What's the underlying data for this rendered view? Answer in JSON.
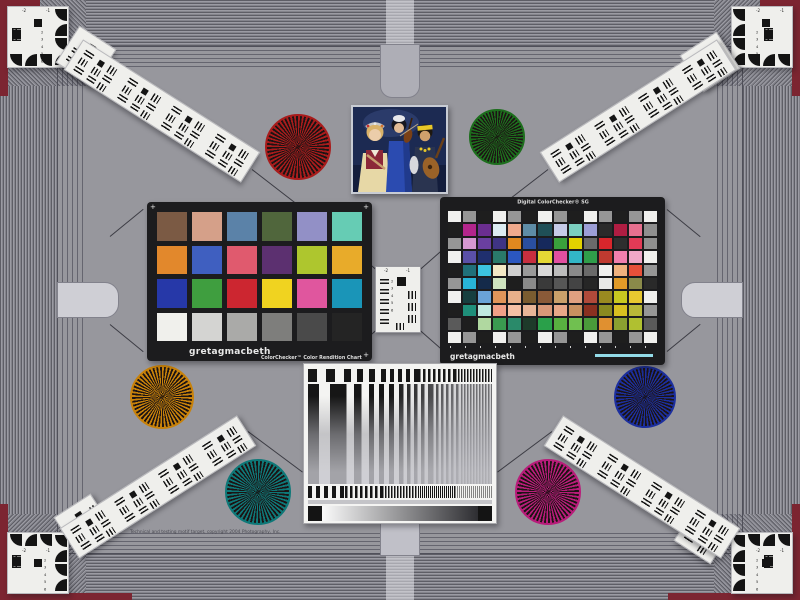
{
  "colors": {
    "background": "#97979d",
    "corner_red": "#7c2531",
    "card_black": "#1c1c1e",
    "card_white": "#efefec",
    "sg_ruler": "#93dbe8"
  },
  "colorchecker24": {
    "brand": "gretagmacbeth",
    "name": "ColorChecker™ Color Rendition Chart",
    "corner_mark": "+",
    "rows": [
      [
        "#7b5a44",
        "#d5a089",
        "#5b82a8",
        "#50663c",
        "#9290c6",
        "#66ccb4"
      ],
      [
        "#e2882c",
        "#3f5fc0",
        "#e05a6e",
        "#5c3070",
        "#aec62e",
        "#e8ab2a"
      ],
      [
        "#2638a8",
        "#3f9e3f",
        "#cc2630",
        "#f0d320",
        "#e0569e",
        "#1a95b8"
      ],
      [
        "#f0f0ec",
        "#d4d4d2",
        "#aaaaa8",
        "#7e7e7c",
        "#4a4a4a",
        "#242424"
      ]
    ]
  },
  "colorchecker_sg": {
    "title": "Digital ColorChecker® SG",
    "brand": "gretagmacbeth",
    "rows": [
      [
        "#f0f0ee",
        "#969696",
        "#1e1e1e",
        "#f0f0ee",
        "#969696",
        "#1e1e1e",
        "#f0f0ee",
        "#969696",
        "#1e1e1e",
        "#f0f0ee",
        "#969696",
        "#1e1e1e",
        "#969696",
        "#f0f0ee"
      ],
      [
        "#1e1e1e",
        "#b3258c",
        "#6b2e90",
        "#dcecf2",
        "#efa98c",
        "#5e8ca6",
        "#1f4f57",
        "#c6cbe8",
        "#7bcfc0",
        "#9c9ed6",
        "#2a2a2a",
        "#b01d42",
        "#e7708f",
        "#8f8f8f"
      ],
      [
        "#969696",
        "#d698d2",
        "#6a3fa0",
        "#3f3484",
        "#e0881f",
        "#2a4fa0",
        "#16295c",
        "#3aa13c",
        "#e2d200",
        "#6a6a6a",
        "#d8262c",
        "#2e2e2e",
        "#e23a56",
        "#8f8f8f"
      ],
      [
        "#f0f0ee",
        "#5a50a8",
        "#1f2f6e",
        "#2a7a6a",
        "#2b57c0",
        "#c82f3f",
        "#e5d935",
        "#e24fa0",
        "#32b7c7",
        "#2f9e4a",
        "#c03a30",
        "#f07fae",
        "#f0a8c8",
        "#f0f0ee"
      ],
      [
        "#1e1e1e",
        "#20707a",
        "#3cc3e0",
        "#f3e9c6",
        "#cfcfcf",
        "#9a9a9a",
        "#d8d8d8",
        "#bcbcbc",
        "#8a8a8a",
        "#6a6a6a",
        "#f0f0ee",
        "#f0b27e",
        "#e8503a",
        "#969696"
      ],
      [
        "#969696",
        "#28b4d8",
        "#142a4a",
        "#cfe4c0",
        "#1e1e1e",
        "#8a8a8a",
        "#3a3a3a",
        "#565656",
        "#444444",
        "#262626",
        "#e8e8e6",
        "#e09a28",
        "#8a8a4a",
        "#2a2a2a"
      ],
      [
        "#f0f0ee",
        "#173f3f",
        "#6aa3d8",
        "#e0955a",
        "#e8b08a",
        "#7a5c30",
        "#8a5a38",
        "#caa06a",
        "#e0a080",
        "#b04a3a",
        "#9a8a20",
        "#c8c820",
        "#e8c830",
        "#f0f0ee"
      ],
      [
        "#1e1e1e",
        "#1f8f7a",
        "#c0e8e0",
        "#f0a088",
        "#f5c0a5",
        "#e8b598",
        "#d89878",
        "#e8a888",
        "#c89060",
        "#8a3020",
        "#8a8a20",
        "#d8c020",
        "#b8b838",
        "#969696"
      ],
      [
        "#5a5a5a",
        "#1e1e1e",
        "#b0d8a0",
        "#3a9a50",
        "#2a8a6a",
        "#1e3a2a",
        "#2aa04a",
        "#58b040",
        "#70c050",
        "#4a9a3a",
        "#e09030",
        "#8aa030",
        "#b0c030",
        "#5a5a5a"
      ],
      [
        "#f0f0ee",
        "#969696",
        "#1e1e1e",
        "#f0f0ee",
        "#969696",
        "#1e1e1e",
        "#f0f0ee",
        "#969696",
        "#1e1e1e",
        "#f0f0ee",
        "#969696",
        "#1e1e1e",
        "#969696",
        "#f0f0ee"
      ]
    ]
  },
  "usaf": {
    "minus2": "-2",
    "minus1": "-1",
    "scale_text": "2\n3\n4\n5\n6"
  },
  "stars": {
    "red": "#a81c1c",
    "green": "#1d6e1d",
    "amber": "#c8820a",
    "teal": "#0e7878",
    "blue": "#1c2f9e",
    "magenta": "#b81c7a"
  },
  "photo": {
    "alt": "three musicians with flute, violin and lute"
  },
  "footer": {
    "copyright": "Technical and testing motif target, copyright 2004 Photography, Inc."
  }
}
